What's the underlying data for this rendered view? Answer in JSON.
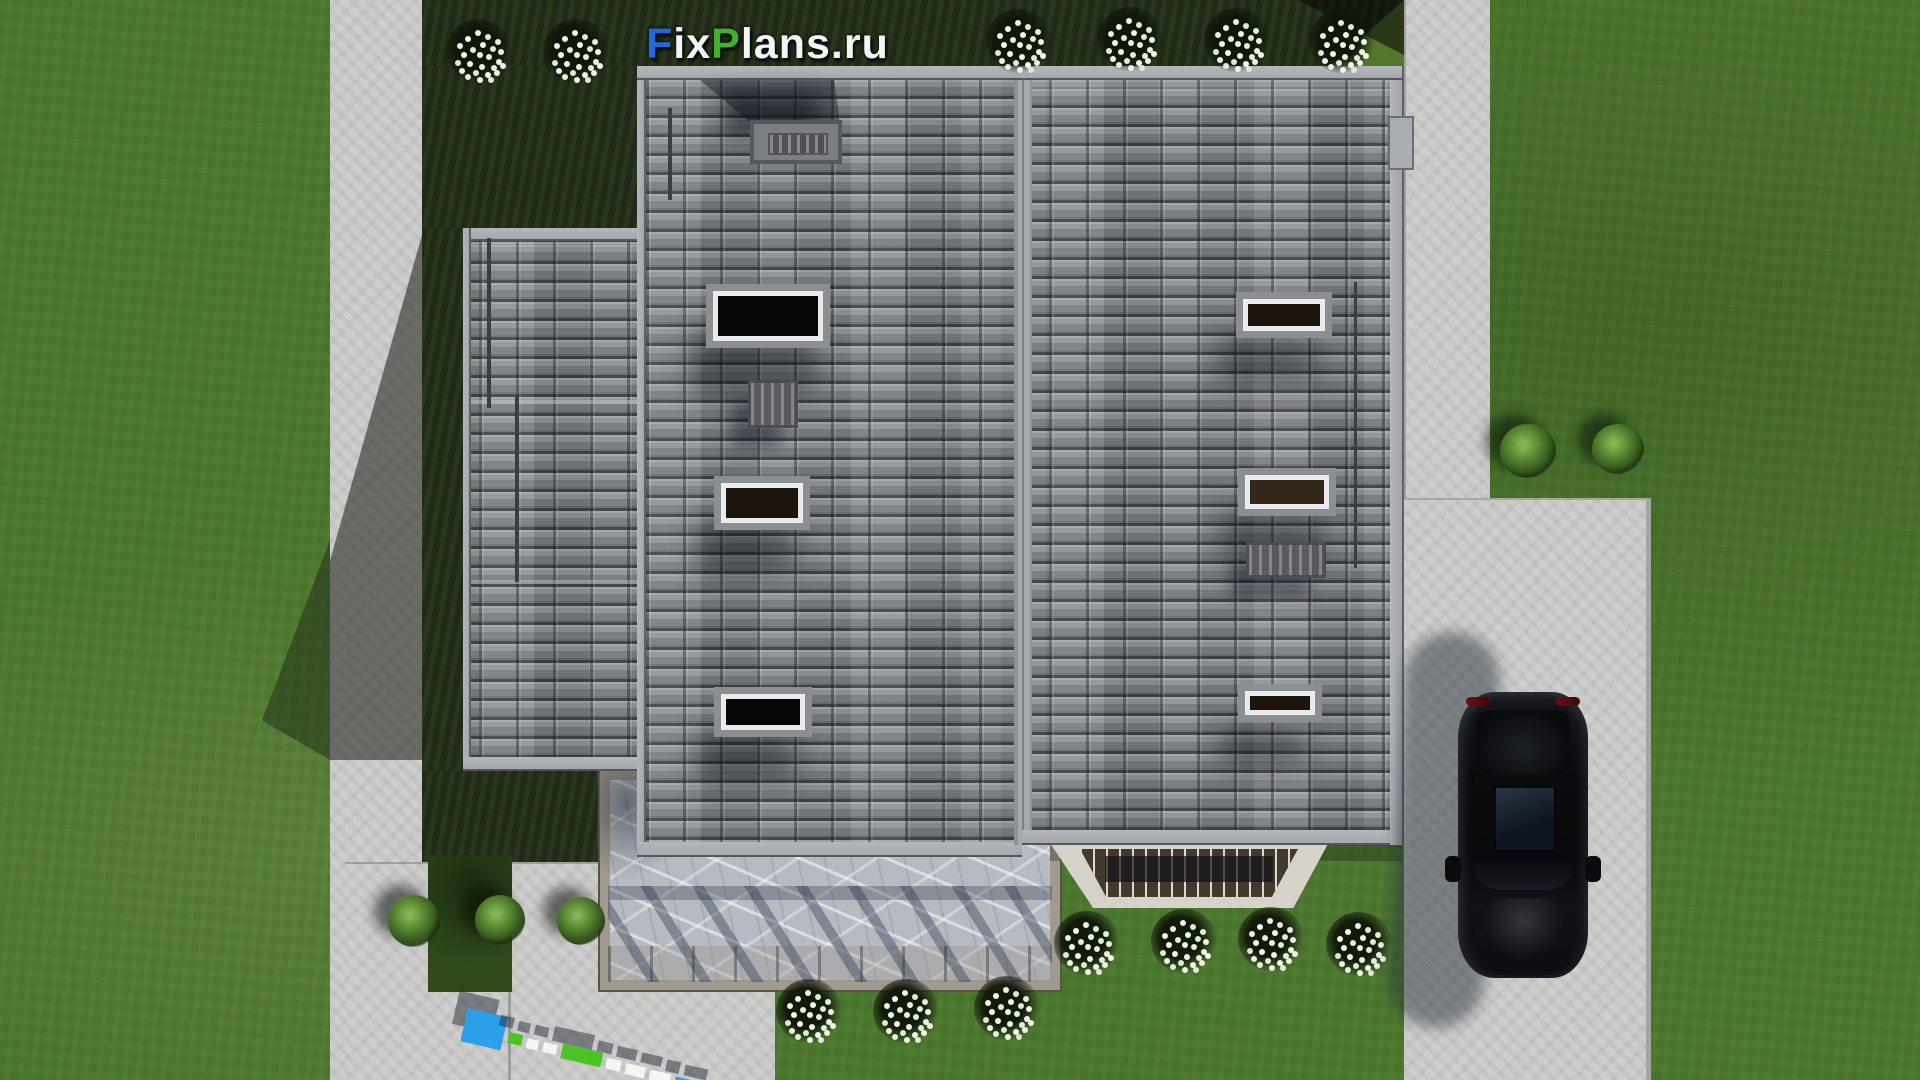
{
  "watermark": {
    "text": "FixPlans.ru",
    "segments": [
      {
        "text": "F",
        "color": "#2268d8"
      },
      {
        "text": "ix",
        "color": "#f3f5f7"
      },
      {
        "text": "P",
        "color": "#3fb12c"
      },
      {
        "text": "lans",
        "color": "#f3f5f7"
      },
      {
        "text": ".ru",
        "color": "#f3f5f7"
      }
    ]
  },
  "ground_watermark": {
    "text": "FixPlans.ru",
    "colors": {
      "blue": "#2b9fe8",
      "green": "#4cc224",
      "white": "#f5f6f4"
    }
  },
  "scene": {
    "description": "Top-down aerial 3D architectural render: house with gray tiled roof, skylights and chimney, marble terrace with railed porch, lawns with shrubs and white flower beds, concrete paths, driveway with parked black car",
    "elements": {
      "skylights_count": 6,
      "roof_vents_count": 2,
      "chimney_count": 1,
      "white_flower_beds_count": 13,
      "green_shrubs_count": 5,
      "car_count": 1
    },
    "colors": {
      "grass_sunlit": "#4e7a30",
      "grass_shadow": "#25311b",
      "roof_tile": "#84888c",
      "roof_fascia": "#a8acb0",
      "concrete": "#c9cac8",
      "marble_terrace": "#b7bbc1",
      "car_body": "#0b0c0e",
      "logo_blue": "#2268d8",
      "logo_green": "#3fb12c"
    }
  }
}
